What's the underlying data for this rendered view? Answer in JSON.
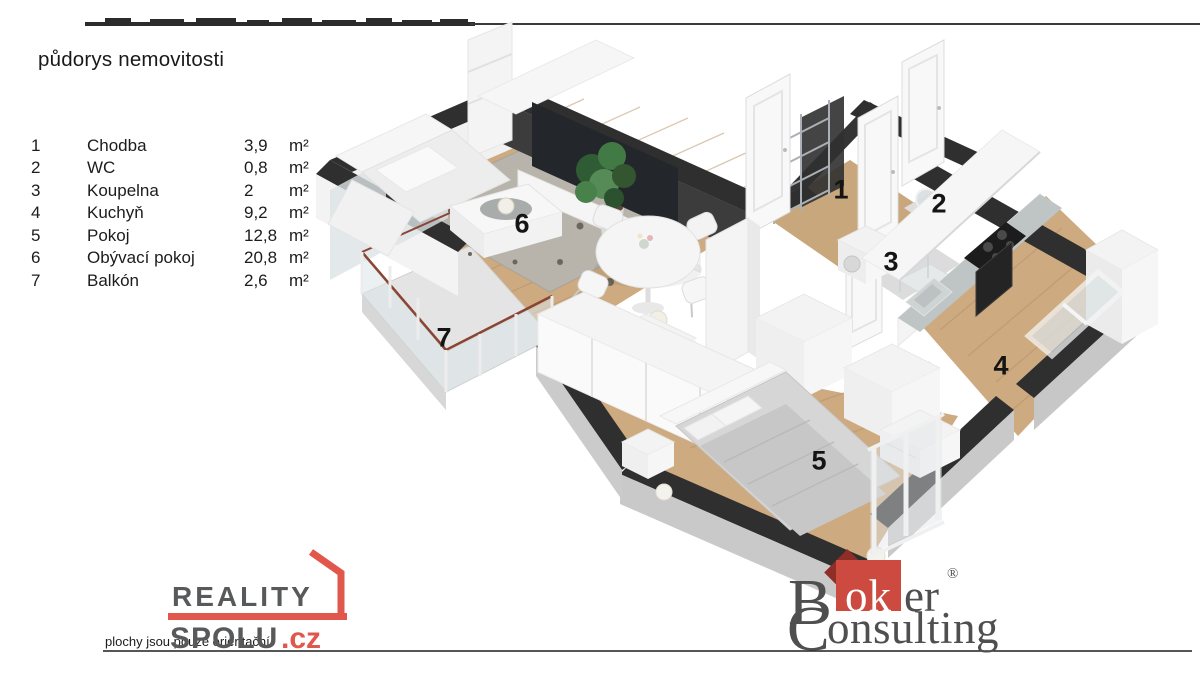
{
  "header": {
    "title": "půdorys nemovitosti"
  },
  "legend": {
    "rows": [
      {
        "num": "1",
        "name": "Chodba",
        "area": "3,9",
        "unit": "m²"
      },
      {
        "num": "2",
        "name": "WC",
        "area": "0,8",
        "unit": "m²"
      },
      {
        "num": "3",
        "name": "Koupelna",
        "area": "2",
        "unit": "m²"
      },
      {
        "num": "4",
        "name": "Kuchyň",
        "area": "9,2",
        "unit": "m²"
      },
      {
        "num": "5",
        "name": "Pokoj",
        "area": "12,8",
        "unit": "m²"
      },
      {
        "num": "6",
        "name": "Obývací pokoj",
        "area": "20,8",
        "unit": "m²"
      },
      {
        "num": "7",
        "name": "Balkón",
        "area": "2,6",
        "unit": "m²"
      }
    ]
  },
  "footer": {
    "disclaimer": "plochy jsou pouze orientační",
    "reality_logo": {
      "word1": "REALITY",
      "word2": "SPOLU",
      "tld": ".cz"
    },
    "broker_logo": {
      "initial_b": "B",
      "ok": "ok",
      "er": "er",
      "registered": "®",
      "initial_c": "C",
      "onsulting": "onsulting"
    }
  },
  "colors": {
    "reality_red": "#e2574c",
    "broker_red": "#cc4a3f",
    "broker_dark_red": "#8e2f27",
    "logo_gray": "#58595b",
    "wall_dark": "#2f2f2f",
    "wood_floor": "#c9a77c",
    "rug_gray": "#b8b3ab",
    "rail_red": "#8a4434"
  }
}
